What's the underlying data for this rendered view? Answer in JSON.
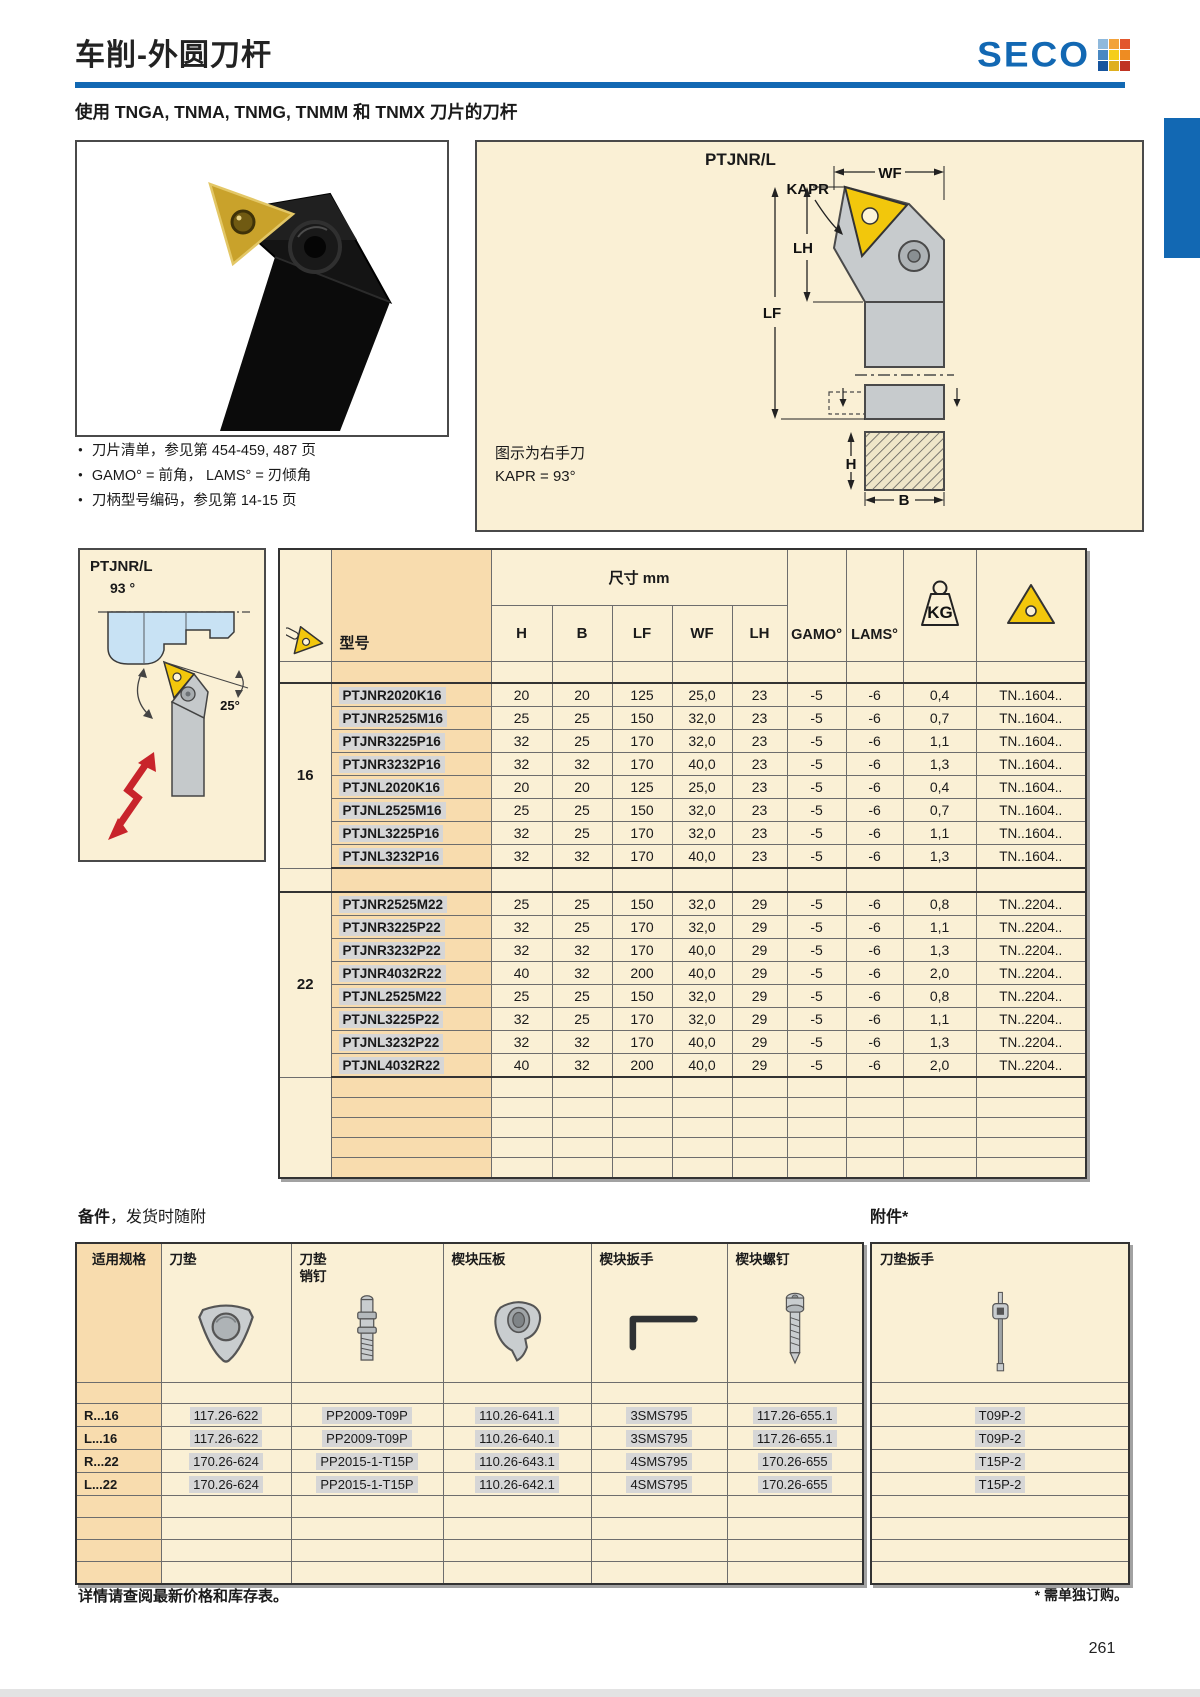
{
  "header": {
    "title": "车削-外圆刀杆",
    "brand": "SECO",
    "subtitle": "使用 TNGA, TNMA, TNMG, TNMM 和 TNMX 刀片的刀杆"
  },
  "colors": {
    "brand_blue": "#1268B3",
    "panel_cream": "#FAF0D5",
    "column_peach": "#F8DCAE",
    "highlight_gray": "#D6D6D6",
    "insert_yellow": "#F2C70C",
    "arrow_red": "#C8242B"
  },
  "logo_grid": [
    "#8FB9DC",
    "#F2A33C",
    "#E2572E",
    "#4A88C2",
    "#F5CE1B",
    "#EE8C22",
    "#16549E",
    "#DFAF1E",
    "#C03422"
  ],
  "bullets": [
    "刀片清单，参见第 454-459, 487 页",
    "GAMO° = 前角， LAMS° = 刃倾角",
    "刀柄型号编码，参见第 14-15 页"
  ],
  "diagram": {
    "title": "PTJNR/L",
    "dim_labels": {
      "kapr": "KAPR",
      "wf": "WF",
      "lh": "LH",
      "lf": "LF",
      "h": "H",
      "b": "B"
    },
    "note1": "图示为右手刀",
    "note2": "KAPR = 93°"
  },
  "side_panel": {
    "model": "PTJNR/L",
    "main_angle": "93 °",
    "lead_angle": "25°"
  },
  "main_table": {
    "dim_header": "尺寸 mm",
    "model_col": "型号",
    "columns": [
      "H",
      "B",
      "LF",
      "WF",
      "LH",
      "GAMO°",
      "LAMS°"
    ],
    "kg_label": "KG",
    "empty_rows": 5,
    "groups": [
      {
        "size": "16",
        "rows": [
          [
            "PTJNR2020K16",
            "20",
            "20",
            "125",
            "25,0",
            "23",
            "-5",
            "-6",
            "0,4",
            "TN..1604.."
          ],
          [
            "PTJNR2525M16",
            "25",
            "25",
            "150",
            "32,0",
            "23",
            "-5",
            "-6",
            "0,7",
            "TN..1604.."
          ],
          [
            "PTJNR3225P16",
            "32",
            "25",
            "170",
            "32,0",
            "23",
            "-5",
            "-6",
            "1,1",
            "TN..1604.."
          ],
          [
            "PTJNR3232P16",
            "32",
            "32",
            "170",
            "40,0",
            "23",
            "-5",
            "-6",
            "1,3",
            "TN..1604.."
          ],
          [
            "PTJNL2020K16",
            "20",
            "20",
            "125",
            "25,0",
            "23",
            "-5",
            "-6",
            "0,4",
            "TN..1604.."
          ],
          [
            "PTJNL2525M16",
            "25",
            "25",
            "150",
            "32,0",
            "23",
            "-5",
            "-6",
            "0,7",
            "TN..1604.."
          ],
          [
            "PTJNL3225P16",
            "32",
            "25",
            "170",
            "32,0",
            "23",
            "-5",
            "-6",
            "1,1",
            "TN..1604.."
          ],
          [
            "PTJNL3232P16",
            "32",
            "32",
            "170",
            "40,0",
            "23",
            "-5",
            "-6",
            "1,3",
            "TN..1604.."
          ]
        ]
      },
      {
        "size": "22",
        "rows": [
          [
            "PTJNR2525M22",
            "25",
            "25",
            "150",
            "32,0",
            "29",
            "-5",
            "-6",
            "0,8",
            "TN..2204.."
          ],
          [
            "PTJNR3225P22",
            "32",
            "25",
            "170",
            "32,0",
            "29",
            "-5",
            "-6",
            "1,1",
            "TN..2204.."
          ],
          [
            "PTJNR3232P22",
            "32",
            "32",
            "170",
            "40,0",
            "29",
            "-5",
            "-6",
            "1,3",
            "TN..2204.."
          ],
          [
            "PTJNR4032R22",
            "40",
            "32",
            "200",
            "40,0",
            "29",
            "-5",
            "-6",
            "2,0",
            "TN..2204.."
          ],
          [
            "PTJNL2525M22",
            "25",
            "25",
            "150",
            "32,0",
            "29",
            "-5",
            "-6",
            "0,8",
            "TN..2204.."
          ],
          [
            "PTJNL3225P22",
            "32",
            "25",
            "170",
            "32,0",
            "29",
            "-5",
            "-6",
            "1,1",
            "TN..2204.."
          ],
          [
            "PTJNL3232P22",
            "32",
            "32",
            "170",
            "40,0",
            "29",
            "-5",
            "-6",
            "1,3",
            "TN..2204.."
          ],
          [
            "PTJNL4032R22",
            "40",
            "32",
            "200",
            "40,0",
            "29",
            "-5",
            "-6",
            "2,0",
            "TN..2204.."
          ]
        ]
      }
    ]
  },
  "spares": {
    "section_title_bold": "备件",
    "section_title_rest": "，发货时随附",
    "accessory_title": "附件*",
    "col_spec": "适用规格",
    "columns": [
      "刀垫",
      "刀垫\n销钉",
      "楔块压板",
      "楔块扳手",
      "楔块螺钉"
    ],
    "accessory_col": "刀垫扳手",
    "empty_rows": 4,
    "rows": [
      {
        "spec": "R...16",
        "cells": [
          "117.26-622",
          "PP2009-T09P",
          "110.26-641.1",
          "3SMS795",
          "117.26-655.1"
        ],
        "accessory": "T09P-2"
      },
      {
        "spec": "L...16",
        "cells": [
          "117.26-622",
          "PP2009-T09P",
          "110.26-640.1",
          "3SMS795",
          "117.26-655.1"
        ],
        "accessory": "T09P-2"
      },
      {
        "spec": "R...22",
        "cells": [
          "170.26-624",
          "PP2015-1-T15P",
          "110.26-643.1",
          "4SMS795",
          "170.26-655"
        ],
        "accessory": "T15P-2"
      },
      {
        "spec": "L...22",
        "cells": [
          "170.26-624",
          "PP2015-1-T15P",
          "110.26-642.1",
          "4SMS795",
          "170.26-655"
        ],
        "accessory": "T15P-2"
      }
    ]
  },
  "footer": {
    "left_note": "详情请查阅最新价格和库存表。",
    "right_note": "* 需单独订购。"
  },
  "page_number": "261"
}
